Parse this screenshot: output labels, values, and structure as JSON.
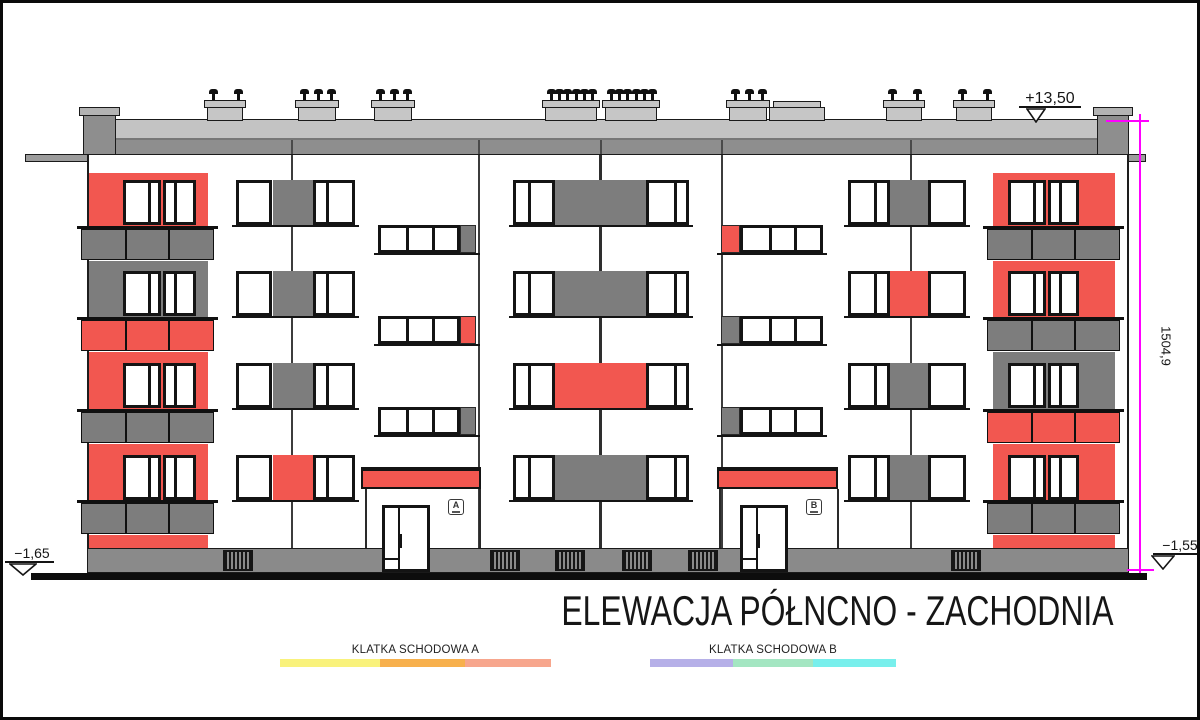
{
  "drawing": {
    "title": "ELEWACJA PÓŁNCNO - ZACHODNIA",
    "levels": {
      "roof": "+13,50",
      "ground_left": "−1,65",
      "ground_right": "−1,55",
      "total_height": "1504,9"
    },
    "entrances": [
      {
        "letter": "A"
      },
      {
        "letter": "B"
      }
    ],
    "legend": [
      {
        "label": "KLATKA SCHODOWA A",
        "colors": [
          "#f9f27c",
          "#f7b04d",
          "#f7a68d"
        ]
      },
      {
        "label": "KLATKA SCHODOWA B",
        "colors": [
          "#b6b0e8",
          "#a4e6c2",
          "#78efec"
        ]
      }
    ],
    "palette": {
      "red": "#f25750",
      "gray": "#7d7d7d",
      "dark_gray": "#8e8e8e",
      "slab_gray": "#c3c3c3",
      "ledge_gray": "#9c9c9c",
      "plinth_gray": "#8a8a8a",
      "chimney_gray": "#c6c6c6",
      "line": "#1a1a1a",
      "magenta": "#ff00ff"
    },
    "balcony_columns": {
      "left": {
        "backgrounds": [
          "red",
          "gray",
          "red",
          "red"
        ],
        "railings": [
          "gray",
          "red",
          "gray",
          "gray"
        ]
      },
      "right": {
        "backgrounds": [
          "red",
          "red",
          "gray",
          "red"
        ],
        "railings": [
          "gray",
          "gray",
          "red",
          "gray"
        ]
      }
    },
    "panel_colors": {
      "section_a": [
        "gray",
        "gray",
        "gray",
        "red"
      ],
      "center": [
        "gray",
        "gray",
        "red",
        "gray"
      ],
      "section_c": [
        "gray",
        "red",
        "gray",
        "gray"
      ]
    },
    "staircase_strip_end_colors": {
      "a": [
        "gray",
        "red",
        "gray"
      ],
      "b": [
        "red",
        "gray",
        "gray"
      ]
    },
    "chimney_vent_counts": [
      2,
      3,
      3,
      6,
      6,
      3,
      2,
      2
    ]
  }
}
